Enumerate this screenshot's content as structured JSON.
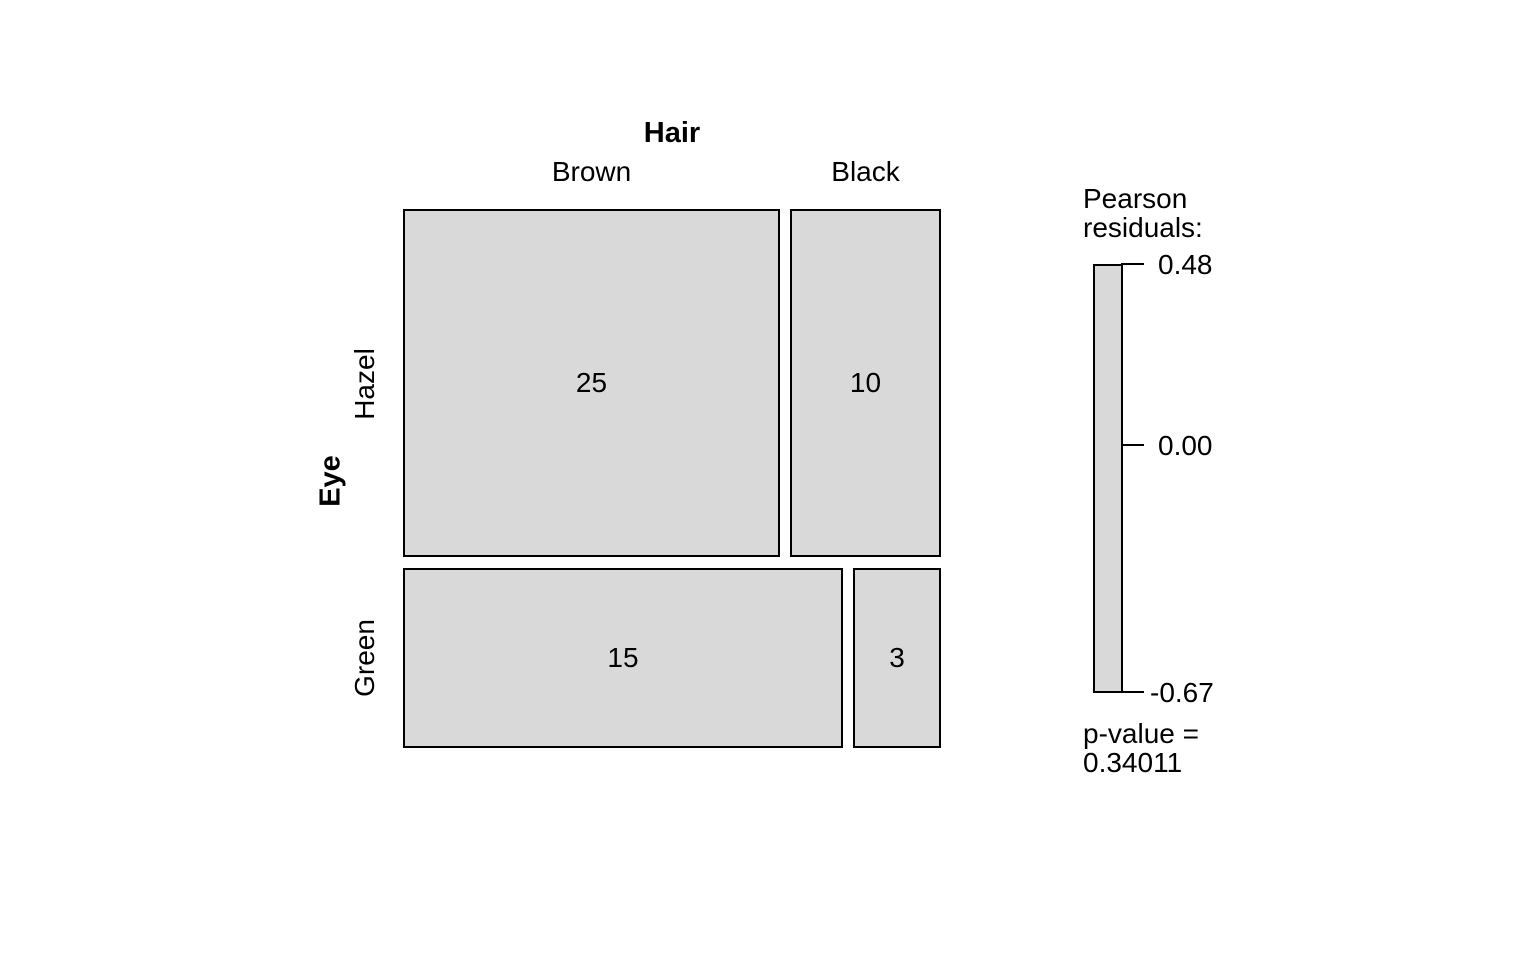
{
  "chart_data": {
    "type": "mosaic",
    "xlabel": "Hair",
    "ylabel": "Eye",
    "col_categories": [
      "Brown",
      "Black"
    ],
    "row_categories": [
      "Hazel",
      "Green"
    ],
    "counts": [
      [
        25,
        10
      ],
      [
        15,
        3
      ]
    ],
    "cells": [
      {
        "row": "Hazel",
        "col": "Brown",
        "count": 25,
        "label": "25"
      },
      {
        "row": "Hazel",
        "col": "Black",
        "count": 10,
        "label": "10"
      },
      {
        "row": "Green",
        "col": "Brown",
        "count": 15,
        "label": "15"
      },
      {
        "row": "Green",
        "col": "Black",
        "count": 3,
        "label": "3"
      }
    ],
    "colors": {
      "cell_fill": "#d9d9d9",
      "cell_border": "#000000",
      "background": "#ffffff"
    },
    "legend": {
      "title_lines": [
        "Pearson",
        "residuals:"
      ],
      "tick_labels": [
        "0.48",
        "0.00",
        "-0.67"
      ],
      "tick_values": [
        0.48,
        0.0,
        -0.67
      ],
      "range": [
        -0.67,
        0.48
      ],
      "p_value_lines": [
        "p-value =",
        "0.34011"
      ]
    }
  }
}
